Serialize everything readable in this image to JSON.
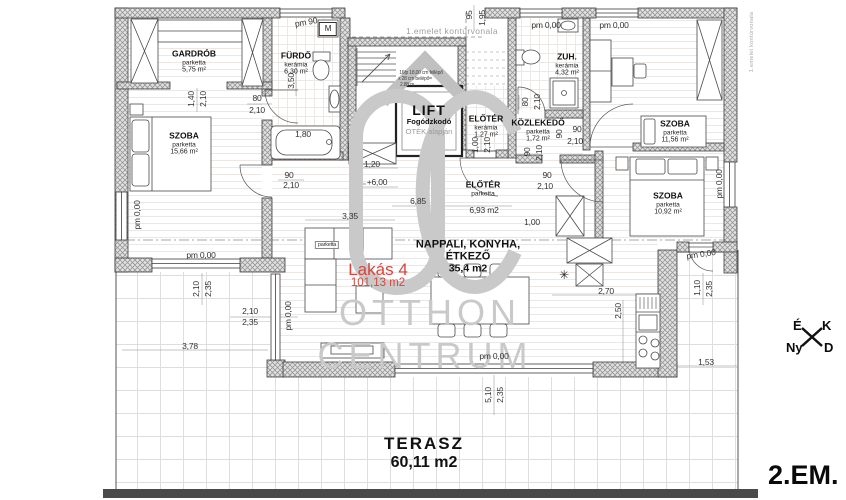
{
  "floor_label": "2.EM.",
  "apartment": {
    "name": "Lakás 4",
    "area": "101,13 m2",
    "accent_color": "#d6453d"
  },
  "watermark": {
    "monogram": "OC",
    "line1": "OTTHON",
    "line2": "CENTRUM",
    "color": "#c9c9c9"
  },
  "compass": {
    "north": "É",
    "east": "K",
    "west": "Ny",
    "south": "D"
  },
  "lift": {
    "name": "LIFT",
    "line2": "Fogódzkodó",
    "line3": "OTÉK alapján"
  },
  "living": {
    "line1": "NAPPALI, KONYHA,",
    "line2": "ÉTKEZŐ",
    "area": "35,4 m2"
  },
  "terrace": {
    "name": "TERASZ",
    "area": "60,11 m2"
  },
  "rooms": [
    {
      "name": "GARDRÓB",
      "sub": "parketta",
      "area": "5,75 m²",
      "x": 194,
      "y": 62
    },
    {
      "name": "FÜRDŐ",
      "sub": "kerámia",
      "area": "6,30 m²",
      "x": 296,
      "y": 64
    },
    {
      "name": "SZOBA",
      "sub": "parketta",
      "area": "15,66 m²",
      "x": 184,
      "y": 144
    },
    {
      "name": "ELŐTÉR",
      "sub": "kerámia",
      "area": "1,27 m²",
      "x": 486,
      "y": 127
    },
    {
      "name": "KÖZLEKEDŐ",
      "sub": "parketta",
      "area": "1,72 m²",
      "x": 538,
      "y": 131
    },
    {
      "name": "ZUH.",
      "sub": "kerámia",
      "area": "4,32 m²",
      "x": 567,
      "y": 65
    },
    {
      "name": "SZOBA",
      "sub": "parketta",
      "area": "11,56 m²",
      "x": 675,
      "y": 132
    },
    {
      "name": "SZOBA",
      "sub": "parketta",
      "area": "10,92 m²",
      "x": 668,
      "y": 204
    },
    {
      "name": "ELŐTÉR",
      "sub": "parketta",
      "area": "",
      "x": 483,
      "y": 189
    }
  ],
  "dims": [
    {
      "t": "pm 90",
      "x": 306,
      "y": 22,
      "r": -10
    },
    {
      "t": "95",
      "x": 469,
      "y": 15,
      "r": -90
    },
    {
      "t": "1,95",
      "x": 482,
      "y": 18,
      "r": -90
    },
    {
      "t": "1.emelet kontúrvonala",
      "x": 452,
      "y": 31,
      "s": "gray",
      "n": "contour-note"
    },
    {
      "t": "pm 0,00",
      "x": 546,
      "y": 25
    },
    {
      "t": "pm 0,00",
      "x": 614,
      "y": 25
    },
    {
      "t": "1.emelet kontúrvonala",
      "x": 752,
      "y": 42,
      "r": -90,
      "s": "graytiny",
      "n": "contour-note"
    },
    {
      "t": "M",
      "x": 328,
      "y": 29,
      "s": "box",
      "n": "washing-machine-label"
    },
    {
      "t": "1,40",
      "x": 191,
      "y": 99,
      "r": -90
    },
    {
      "t": "2,10",
      "x": 203,
      "y": 99,
      "r": -90
    },
    {
      "t": "80",
      "x": 257,
      "y": 98
    },
    {
      "t": "2,10",
      "x": 257,
      "y": 110
    },
    {
      "t": "3,50",
      "x": 291,
      "y": 81,
      "r": -90
    },
    {
      "t": "1,80",
      "x": 303,
      "y": 134
    },
    {
      "t": "16fp 18,00 cm fellépő",
      "x": 421,
      "y": 73,
      "s": "tiny"
    },
    {
      "t": "x 28 cm belépő=",
      "x": 415,
      "y": 79,
      "s": "tiny"
    },
    {
      "t": "2,88 m",
      "x": 407,
      "y": 85,
      "s": "tiny"
    },
    {
      "t": "1,20",
      "x": 372,
      "y": 164
    },
    {
      "t": "+6,00",
      "x": 377,
      "y": 182
    },
    {
      "t": "6,85",
      "x": 418,
      "y": 201
    },
    {
      "t": "6,93 m2",
      "x": 484,
      "y": 210
    },
    {
      "t": "3,35",
      "x": 350,
      "y": 216
    },
    {
      "t": "1,00",
      "x": 532,
      "y": 222
    },
    {
      "t": "80",
      "x": 525,
      "y": 102,
      "r": -90
    },
    {
      "t": "2,10",
      "x": 537,
      "y": 102,
      "r": -90
    },
    {
      "t": "1,00",
      "x": 475,
      "y": 145,
      "r": -90
    },
    {
      "t": "2,10",
      "x": 487,
      "y": 145,
      "r": -90
    },
    {
      "t": "90",
      "x": 559,
      "y": 134,
      "r": -90
    },
    {
      "t": "90",
      "x": 577,
      "y": 129
    },
    {
      "t": "2,10",
      "x": 575,
      "y": 141
    },
    {
      "t": "90",
      "x": 527,
      "y": 152,
      "r": -90
    },
    {
      "t": "2,10",
      "x": 539,
      "y": 153,
      "r": -90
    },
    {
      "t": "90",
      "x": 547,
      "y": 175
    },
    {
      "t": "2,10",
      "x": 545,
      "y": 186
    },
    {
      "t": "90",
      "x": 289,
      "y": 175
    },
    {
      "t": "2,10",
      "x": 291,
      "y": 185
    },
    {
      "t": "pm 0,00",
      "x": 137,
      "y": 215,
      "r": -90
    },
    {
      "t": "pm 0,00",
      "x": 201,
      "y": 255
    },
    {
      "t": "2,10",
      "x": 196,
      "y": 289,
      "r": -90
    },
    {
      "t": "2,35",
      "x": 208,
      "y": 289,
      "r": -90
    },
    {
      "t": "2,10",
      "x": 250,
      "y": 311
    },
    {
      "t": "2,35",
      "x": 250,
      "y": 322
    },
    {
      "t": "pm 0,00",
      "x": 288,
      "y": 316,
      "r": -90
    },
    {
      "t": "3,78",
      "x": 190,
      "y": 346
    },
    {
      "t": "pm 0,00",
      "x": 494,
      "y": 356
    },
    {
      "t": "5,10",
      "x": 488,
      "y": 395,
      "r": -90
    },
    {
      "t": "2,35",
      "x": 500,
      "y": 395,
      "r": -90
    },
    {
      "t": "2,70",
      "x": 606,
      "y": 291
    },
    {
      "t": "2,50",
      "x": 618,
      "y": 311,
      "r": -90
    },
    {
      "t": "1,10",
      "x": 697,
      "y": 288,
      "r": -90
    },
    {
      "t": "2,35",
      "x": 709,
      "y": 289,
      "r": -90
    },
    {
      "t": "1,53",
      "x": 706,
      "y": 362
    },
    {
      "t": "pm 0,00",
      "x": 701,
      "y": 254,
      "r": -8
    },
    {
      "t": "pm 0,00",
      "x": 719,
      "y": 184,
      "r": -90
    },
    {
      "t": "parketta",
      "x": 327,
      "y": 245,
      "s": "tinybox",
      "n": "floor-material-note"
    },
    {
      "t": "✳",
      "x": 564,
      "y": 275,
      "s": "icon",
      "n": "snowflake-icon"
    }
  ]
}
